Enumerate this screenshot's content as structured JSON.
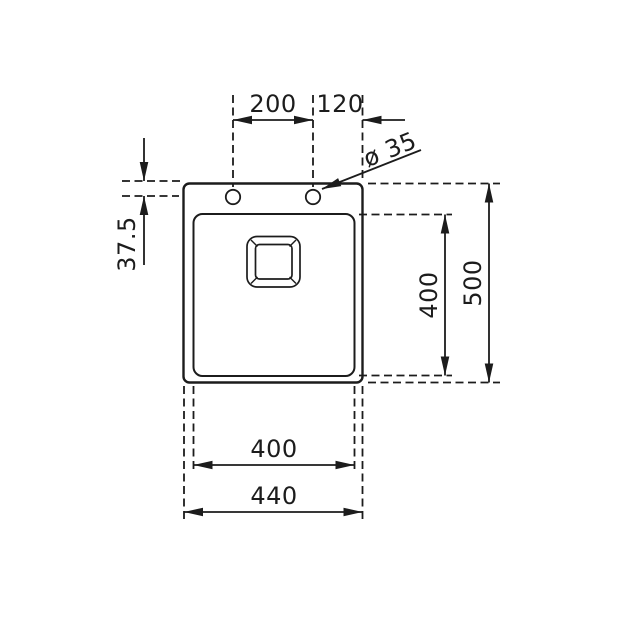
{
  "drawing": {
    "background_color": "#ffffff",
    "line_color": "#1c1c1c",
    "dimensions": {
      "top_hole_spacing": "200",
      "top_hole_to_edge": "120",
      "hole_diameter": "ø 35",
      "edge_to_hole_centerline": "37.5",
      "bowl_length": "400",
      "overall_length": "500",
      "bowl_width": "400",
      "overall_width": "440"
    }
  }
}
